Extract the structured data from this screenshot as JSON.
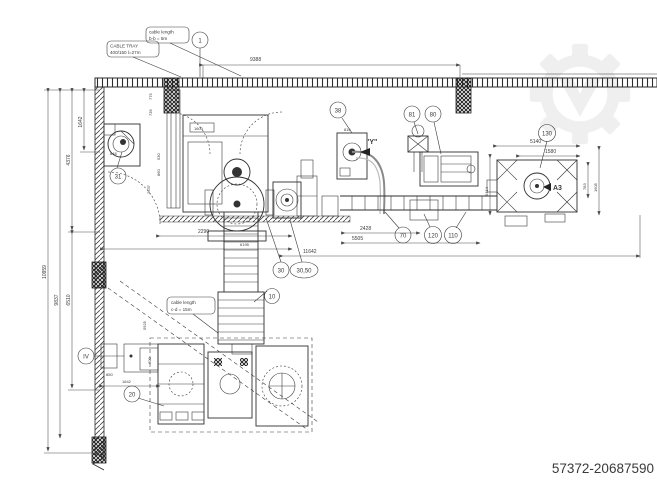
{
  "page": {
    "id_text": "57372-20687590"
  },
  "labels": {
    "cable_tray_line1": "CABLE TRAY",
    "cable_tray_line2": "400/150  l=27m",
    "cable_top_line1": "cable length",
    "cable_top_line2": "b-b = 5m",
    "cable_mid_line1": "cable length",
    "cable_mid_line2": "c-d = 15m"
  },
  "views": {
    "y_label": "\"Y\"",
    "a3_label": "A3"
  },
  "callouts": {
    "c1": "1",
    "c31": "31",
    "c38": "38",
    "c81": "81",
    "c80": "80",
    "c130": "130",
    "c70": "70",
    "c120": "120",
    "c110": "110",
    "c30": "30",
    "c30_50": "30,50",
    "c10": "10",
    "c20": "20",
    "c_iv": "IV"
  },
  "dims": {
    "top_9388": "9388",
    "left_1642": "1642",
    "left_4376": "4376",
    "left_9837": "9837",
    "left_10959": "10959",
    "left_6510": "6510",
    "fan_848": "848",
    "v_2637": "2637",
    "v_530": "530",
    "v_860": "860",
    "duct_775": "775",
    "duct_735": "735",
    "cab_1600": "1600",
    "cab38_816": "816",
    "mid_2290": "2290",
    "mid_6195": "6195",
    "mid_11642": "11642",
    "mid_2428": "2428",
    "mid_5505": "5505",
    "right_5140": "5140",
    "right_1580": "1580",
    "right_783": "783",
    "right_1605": "1605",
    "right_5414": "5414",
    "bl_600": "600",
    "bl_850": "850",
    "bl_1642": "1642",
    "bl_5925": "5925"
  },
  "colors": {
    "line": "#3a3a3a",
    "watermark": "#efefef",
    "id_text": "#979797"
  }
}
